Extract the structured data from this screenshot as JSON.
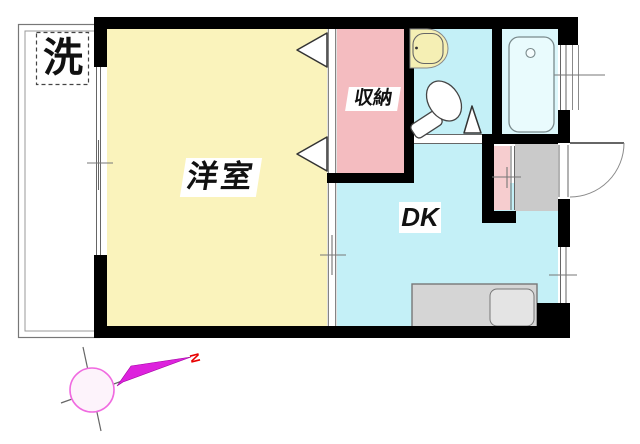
{
  "app": {
    "type": "floor-plan",
    "description": "Japanese 1DK apartment floor plan"
  },
  "rooms": {
    "western_room": {
      "label": "洋室"
    },
    "closet": {
      "label": "収納"
    },
    "dining_kitchen": {
      "label": "DK"
    },
    "laundry_spot": {
      "label": "洗"
    }
  },
  "fixtures": {
    "bathtub": "bathtub with faucet",
    "toilet": "toilet",
    "washbasin": "washbasin",
    "kitchen_counter": "kitchen counter with sink",
    "entrance_door": "outward swinging entrance door",
    "closet_doors": "two fold-door markers",
    "washroom_door": "door swing triangle"
  },
  "compass": {
    "north_label": "N",
    "direction": "north pointing upper-right"
  },
  "colors": {
    "room-yellow": "#FAF3BC",
    "closet-pink": "#F4BCC0",
    "dk-cyan": "#C4F0F7",
    "bath-cyan": "#DCF7FB",
    "tub-fill": "#E9FBFD",
    "basin-yellow": "#F5EFB4",
    "genkan-gray": "#CACACA",
    "counter-gray": "#D5D5D5",
    "sink-gray": "#E4E4E4",
    "entry-pink": "#F6CDCF",
    "wall-black": "#000000",
    "compass-magenta": "#F06AE0",
    "compass-fill": "#FDF3FB",
    "arrow-magenta": "#DD22DD",
    "north-red": "#E80000"
  }
}
